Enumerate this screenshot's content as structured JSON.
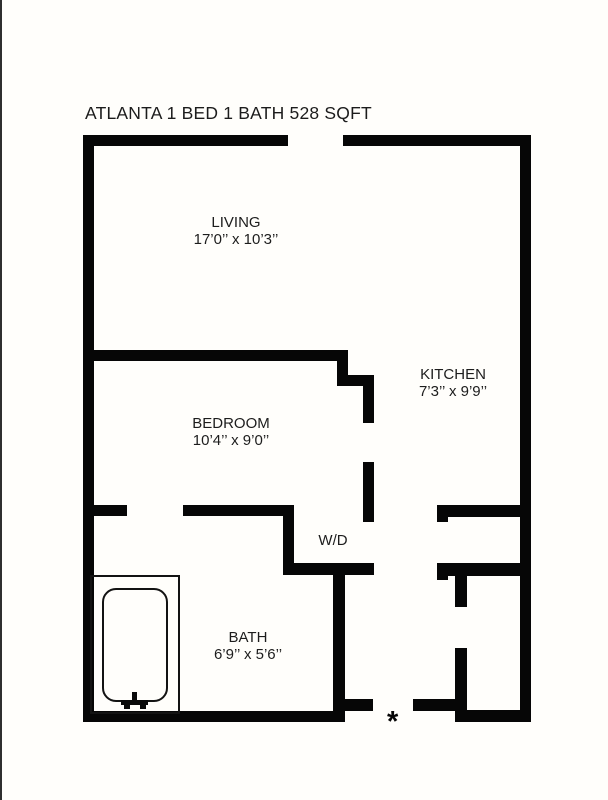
{
  "title": "ATLANTA 1 BED 1 BATH 528 SQFT",
  "rooms": {
    "living": {
      "name": "LIVING",
      "dims": "17’0’’ x 10’3’’"
    },
    "kitchen": {
      "name": "KITCHEN",
      "dims": "7’3’’ x 9’9’’"
    },
    "bedroom": {
      "name": "BEDROOM",
      "dims": "10’4’’ x 9’0’’"
    },
    "bath": {
      "name": "BATH",
      "dims": "6’9’’ x 5’6’’"
    },
    "laundry": {
      "name": "W/D"
    }
  },
  "entry_marker": "*",
  "colors": {
    "wall": "#060606",
    "background": "#fffefb",
    "text": "#1d1d1d"
  }
}
